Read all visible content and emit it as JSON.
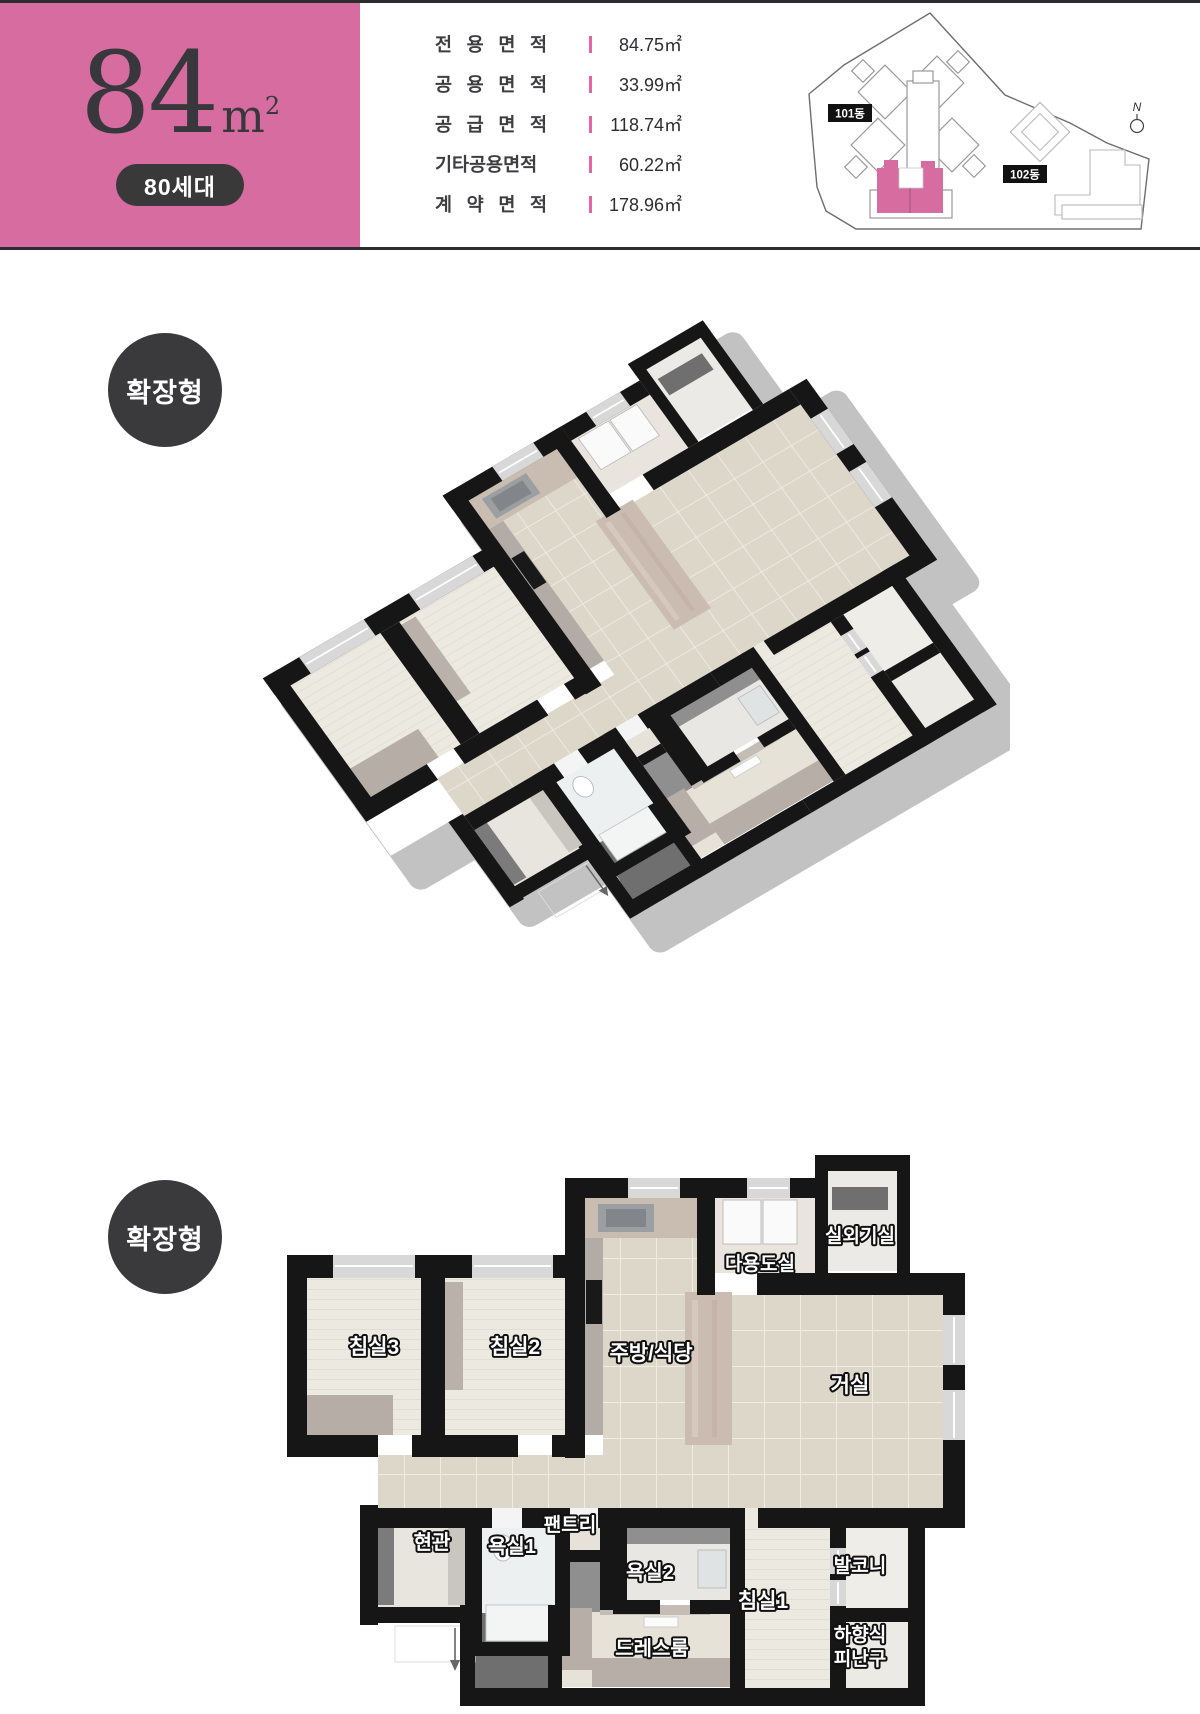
{
  "header": {
    "accent_pink": "#d66ca0",
    "dark_charcoal": "#3a3a3c",
    "size_value": "84",
    "size_unit_base": "m",
    "size_unit_sup": "2",
    "households": "80세대",
    "area_table": [
      {
        "label": "전 용 면 적",
        "value": "84.75㎡"
      },
      {
        "label": "공 용 면 적",
        "value": "33.99㎡"
      },
      {
        "label": "공 급 면 적",
        "value": "118.74㎡"
      },
      {
        "label": "기타공용면적",
        "value": "60.22㎡"
      },
      {
        "label": "계 약 면 적",
        "value": "178.96㎡"
      }
    ],
    "site_plan": {
      "building_101": "101동",
      "building_102": "102동",
      "north": "N"
    }
  },
  "sections": {
    "iso_badge": "확장형",
    "plan_badge": "확장형"
  },
  "rooms": {
    "bedroom3": "침실3",
    "bedroom2": "침실2",
    "kitchen_dining": "주방/식당",
    "living": "거실",
    "utility": "다용도실",
    "outdoor_unit": "실외기실",
    "entrance": "현관",
    "bath1": "욕실1",
    "pantry": "팬트리",
    "bath2": "욕실2",
    "bedroom1": "침실1",
    "balcony": "발코니",
    "dressroom": "드레스룸",
    "escape_line1": "하향식",
    "escape_line2": "피난구"
  }
}
